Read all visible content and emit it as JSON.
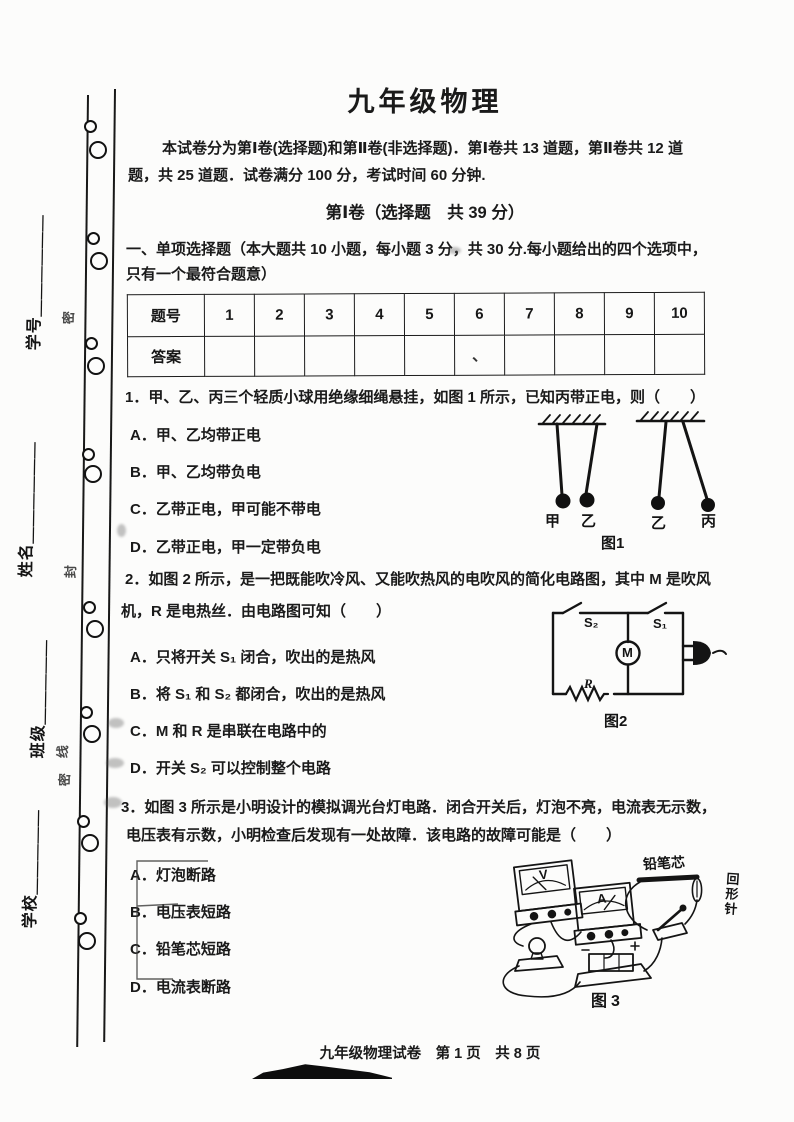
{
  "page": {
    "title": "九年级物理",
    "intro_line1": "本试卷分为第Ⅰ卷(选择题)和第Ⅱ卷(非选择题)．第Ⅰ卷共 13 道题，第Ⅱ卷共 12 道",
    "intro_line2": "题，共 25 道题．试卷满分 100 分，考试时间 60 分钟.",
    "section_title": "第Ⅰ卷（选择题　共 39 分）",
    "part_line1": "一、单项选择题（本大题共 10 小题，每小题 3 分，共 30 分.每小题给出的四个选项中，",
    "part_line2": "只有一个最符合题意）",
    "footer": "九年级物理试卷　第 1 页　共 8 页"
  },
  "margin": {
    "field_student_id": "学号＿＿＿＿＿＿",
    "field_name": "姓名＿＿＿＿＿＿",
    "field_class": "班级＿＿＿＿＿",
    "field_school": "学校＿＿＿＿＿",
    "seal_char_1": "密",
    "seal_char_2": "封",
    "seal_char_3": "线",
    "seal_char_4": "密"
  },
  "answer_table": {
    "corner_label": "题号",
    "row_label": "答案",
    "numbers": [
      "1",
      "2",
      "3",
      "4",
      "5",
      "6",
      "7",
      "8",
      "9",
      "10"
    ],
    "stray_mark": "、"
  },
  "q1": {
    "stem": "1．甲、乙、丙三个轻质小球用绝缘细绳悬挂，如图 1 所示，已知丙带正电，则（　　）",
    "options": [
      "A．甲、乙均带正电",
      "B．甲、乙均带负电",
      "C．乙带正电，甲可能不带电",
      "D．乙带正电，甲一定带负电"
    ],
    "figure": {
      "caption": "图1",
      "label_jia": "甲",
      "label_yi_left": "乙",
      "label_yi_right": "乙",
      "label_bing": "丙"
    }
  },
  "q2": {
    "stem_line1": "2．如图 2 所示，是一把既能吹冷风、又能吹热风的电吹风的简化电路图，其中 M 是吹风",
    "stem_line2": "机，R 是电热丝．由电路图可知（　　）",
    "options": [
      "A．只将开关 S₁ 闭合，吹出的是热风",
      "B．将 S₁ 和 S₂ 都闭合，吹出的是热风",
      "C．M 和 R 是串联在电路中的",
      "D．开关 S₂ 可以控制整个电路"
    ],
    "figure": {
      "caption": "图2",
      "switch_left": "S₂",
      "switch_right": "S₁",
      "motor": "M",
      "resistor": "R"
    }
  },
  "q3": {
    "stem_line1": "3．如图 3 所示是小明设计的模拟调光台灯电路．闭合开关后，灯泡不亮，电流表无示数，",
    "stem_line2": "电压表有示数，小明检查后发现有一处故障．该电路的故障可能是（　　）",
    "options": [
      "A．灯泡断路",
      "B．电压表短路",
      "C．铅笔芯短路",
      "D．电流表断路"
    ],
    "figure": {
      "caption": "图3",
      "label_pencil": "铅笔芯",
      "label_clip": "回形针",
      "meter_v": "V",
      "meter_a": "A"
    }
  }
}
